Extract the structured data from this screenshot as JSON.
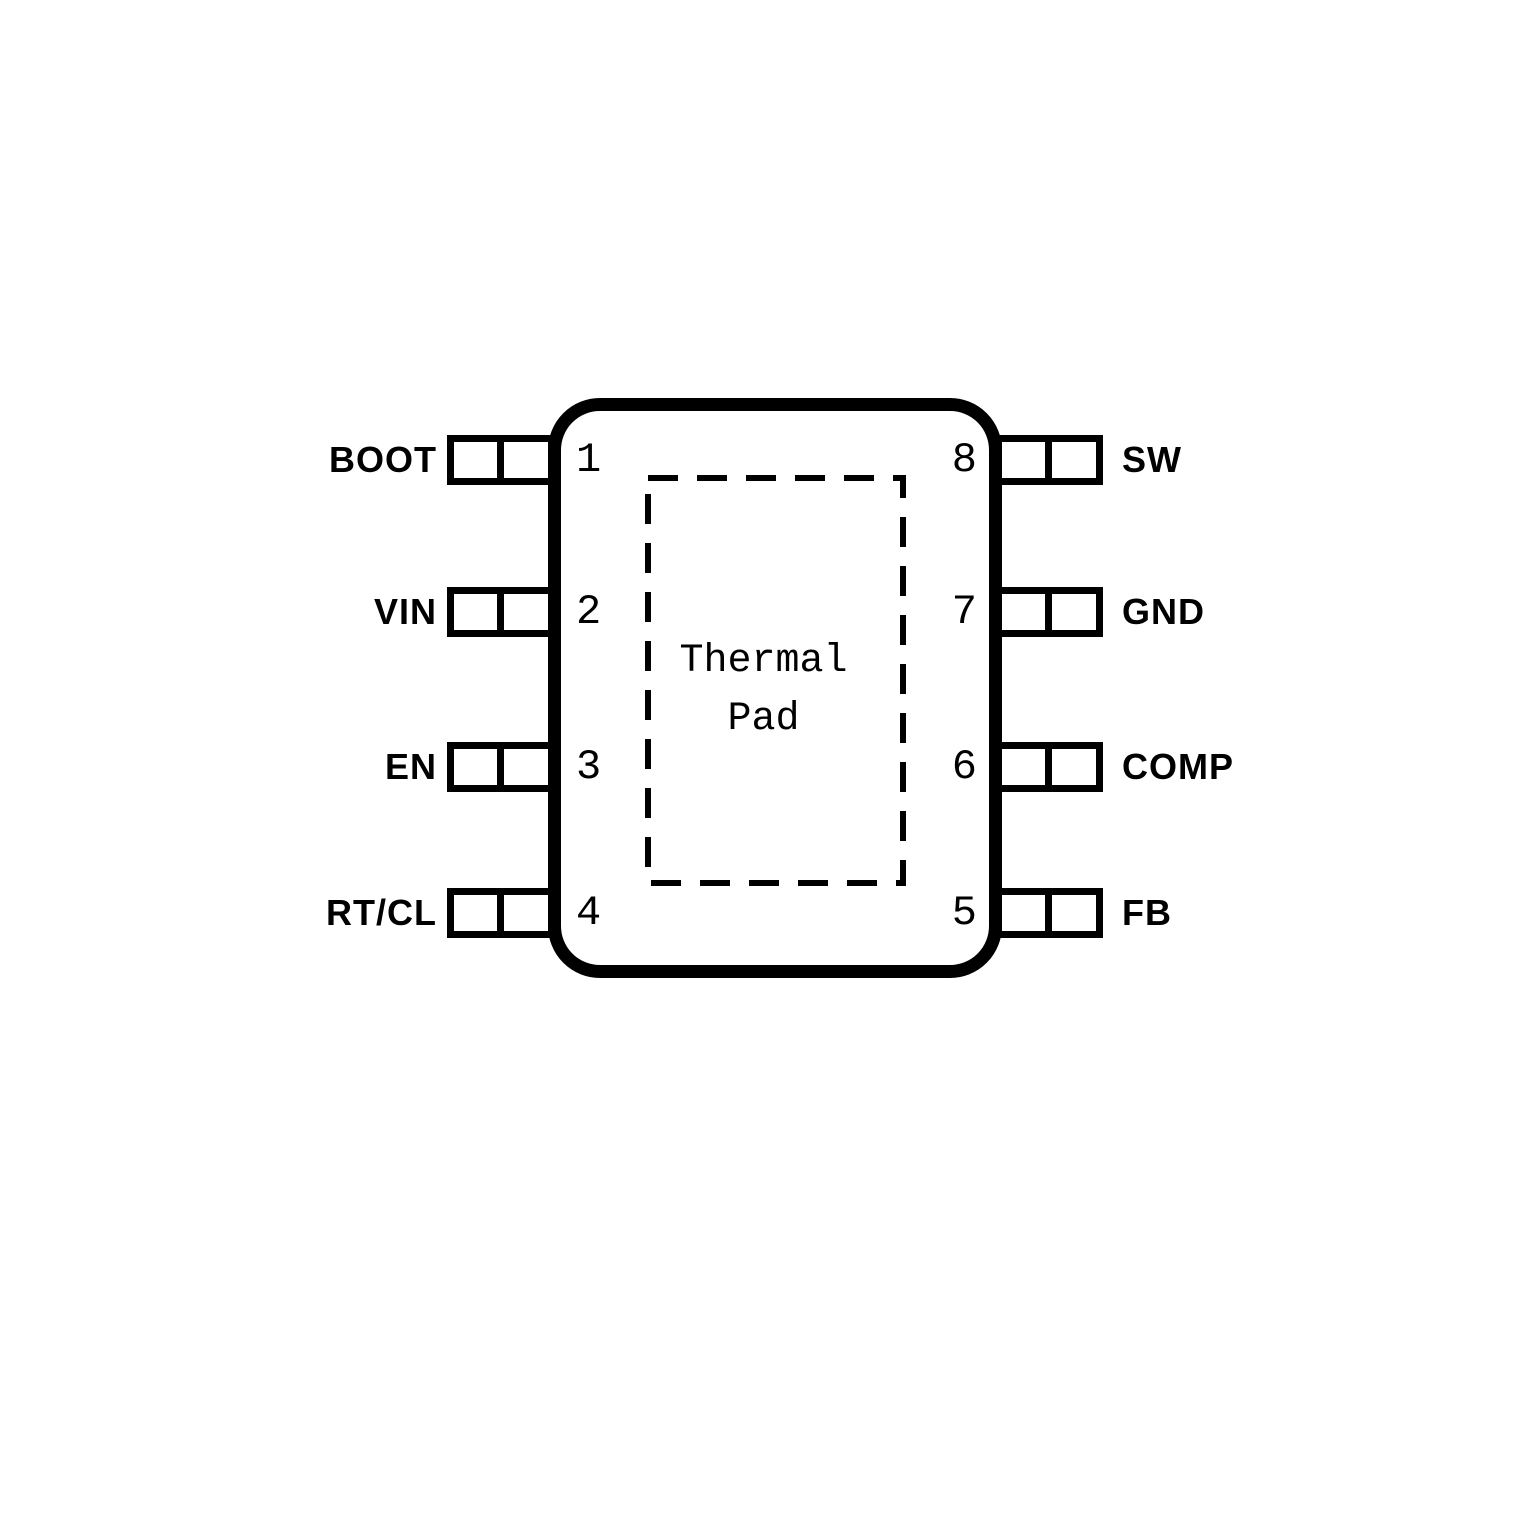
{
  "pinout": {
    "thermal_pad": {
      "line1": "Thermal",
      "line2": "Pad"
    },
    "pins": {
      "left": [
        {
          "number": "1",
          "label": "BOOT"
        },
        {
          "number": "2",
          "label": "VIN"
        },
        {
          "number": "3",
          "label": "EN"
        },
        {
          "number": "4",
          "label": "RT/CL"
        }
      ],
      "right": [
        {
          "number": "8",
          "label": "SW"
        },
        {
          "number": "7",
          "label": "GND"
        },
        {
          "number": "6",
          "label": "COMP"
        },
        {
          "number": "5",
          "label": "FB"
        }
      ]
    },
    "colors": {
      "line": "#000000",
      "background": "#ffffff"
    }
  }
}
